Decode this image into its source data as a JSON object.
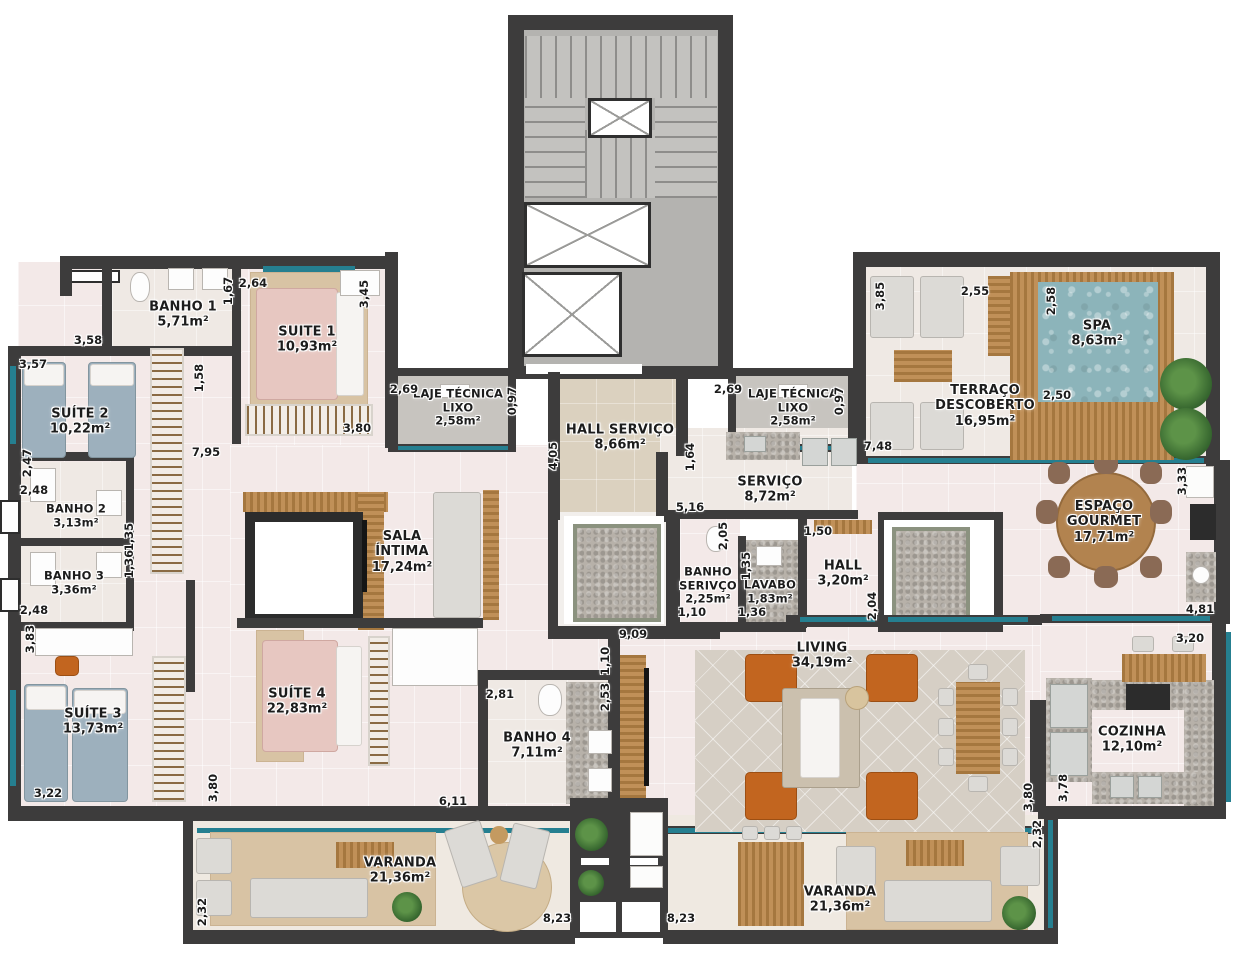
{
  "plan": {
    "rooms": [
      {
        "name": "BANHO 1",
        "area": "5,71m²"
      },
      {
        "name": "SUITE 1",
        "area": "10,93m²"
      },
      {
        "name": "SUÍTE 2",
        "area": "10,22m²"
      },
      {
        "name": "BANHO 2",
        "area": "3,13m²"
      },
      {
        "name": "BANHO 3",
        "area": "3,36m²"
      },
      {
        "name": "SUÍTE 3",
        "area": "13,73m²"
      },
      {
        "name": "SUÍTE 4",
        "area": "22,83m²"
      },
      {
        "name": "SALA\nÍNTIMA",
        "area": "17,24m²"
      },
      {
        "name": "BANHO 4",
        "area": "7,11m²"
      },
      {
        "name": "VARANDA",
        "area": "21,36m²"
      },
      {
        "name": "LAJE TÉCNICA\nLIXO",
        "area": "2,58m²"
      },
      {
        "name": "HALL SERVIÇO",
        "area": "8,66m²"
      },
      {
        "name": "LAJE TÉCNICA\nLIXO",
        "area": "2,58m²"
      },
      {
        "name": "SERVIÇO",
        "area": "8,72m²"
      },
      {
        "name": "BANHO\nSERIVÇO",
        "area": "2,25m²"
      },
      {
        "name": "LAVABO",
        "area": "1,83m²"
      },
      {
        "name": "HALL",
        "area": "3,20m²"
      },
      {
        "name": "LIVING",
        "area": "34,19m²"
      },
      {
        "name": "TERRAÇO\nDESCOBERTO",
        "area": "16,95m²"
      },
      {
        "name": "SPA",
        "area": "8,63m²"
      },
      {
        "name": "ESPAÇO\nGOURMET",
        "area": "17,71m²"
      },
      {
        "name": "COZINHA",
        "area": "12,10m²"
      },
      {
        "name": "VARANDA",
        "area": "21,36m²"
      }
    ],
    "dims": [
      "1,67",
      "2,64",
      "3,45",
      "3,58",
      "3,57",
      "1,58",
      "2,69",
      "0,97",
      "2,69",
      "0,97",
      "3,80",
      "7,95",
      "2,47",
      "2,48",
      "1,35",
      "1,36",
      "2,48",
      "3,83",
      "3,22",
      "3,80",
      "4,05",
      "1,64",
      "5,16",
      "2,05",
      "1,35",
      "1,10",
      "1,36",
      "1,50",
      "2,04",
      "9,09",
      "1,10",
      "2,53",
      "2,81",
      "6,11",
      "8,23",
      "8,23",
      "2,32",
      "2,32",
      "3,85",
      "2,55",
      "2,58",
      "2,50",
      "7,48",
      "3,33",
      "4,81",
      "3,20",
      "3,78",
      "3,80"
    ]
  }
}
